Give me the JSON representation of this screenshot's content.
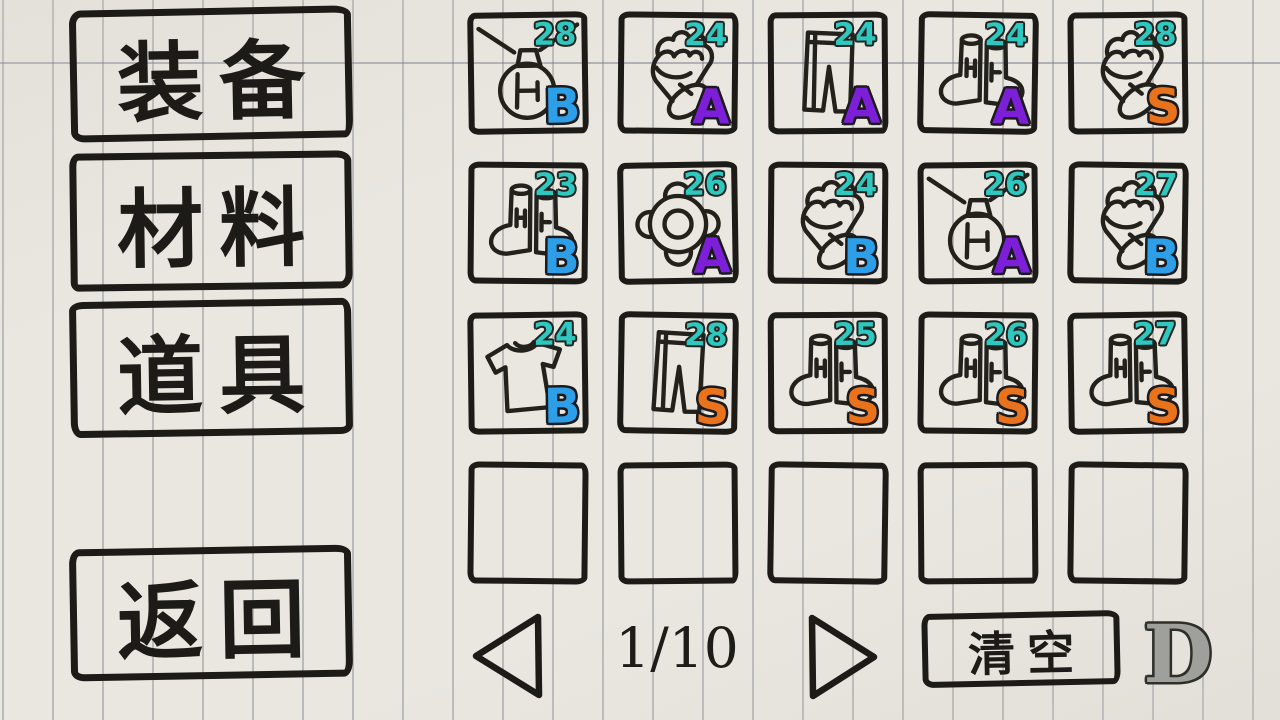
{
  "sidebar": {
    "buttons": [
      {
        "id": "equipment",
        "label": "装备"
      },
      {
        "id": "materials",
        "label": "材料"
      },
      {
        "id": "items",
        "label": "道具"
      },
      {
        "id": "back",
        "label": "返回"
      }
    ]
  },
  "inventory": {
    "rows": 4,
    "cols": 5,
    "count_color": "#2fc8c0",
    "grade_colors": {
      "B": "#2d9fe8",
      "A": "#7d1ed8",
      "S": "#e9731c"
    },
    "slots": [
      {
        "icon": "necklace",
        "count": "28",
        "grade": "B"
      },
      {
        "icon": "gauntlet",
        "count": "24",
        "grade": "A"
      },
      {
        "icon": "pants",
        "count": "24",
        "grade": "A"
      },
      {
        "icon": "boots",
        "count": "24",
        "grade": "A"
      },
      {
        "icon": "gauntlet",
        "count": "28",
        "grade": "S"
      },
      {
        "icon": "boots",
        "count": "23",
        "grade": "B"
      },
      {
        "icon": "ring",
        "count": "26",
        "grade": "A"
      },
      {
        "icon": "gauntlet",
        "count": "24",
        "grade": "B"
      },
      {
        "icon": "necklace",
        "count": "26",
        "grade": "A"
      },
      {
        "icon": "gauntlet",
        "count": "27",
        "grade": "B"
      },
      {
        "icon": "shirt",
        "count": "24",
        "grade": "B"
      },
      {
        "icon": "pants",
        "count": "28",
        "grade": "S"
      },
      {
        "icon": "boots",
        "count": "25",
        "grade": "S"
      },
      {
        "icon": "boots",
        "count": "26",
        "grade": "S"
      },
      {
        "icon": "boots",
        "count": "27",
        "grade": "S"
      },
      {
        "icon": null
      },
      {
        "icon": null
      },
      {
        "icon": null
      },
      {
        "icon": null
      },
      {
        "icon": null
      }
    ]
  },
  "pagination": {
    "current": "1",
    "total": "10",
    "display": "1/10"
  },
  "actions": {
    "clear_label": "清空",
    "rank_label": "D"
  },
  "colors": {
    "paper": "#e9e7e0",
    "ink": "#1d1b17",
    "ruled_line": "#7a8086",
    "rank_d_gray": "#9f9f9b"
  }
}
